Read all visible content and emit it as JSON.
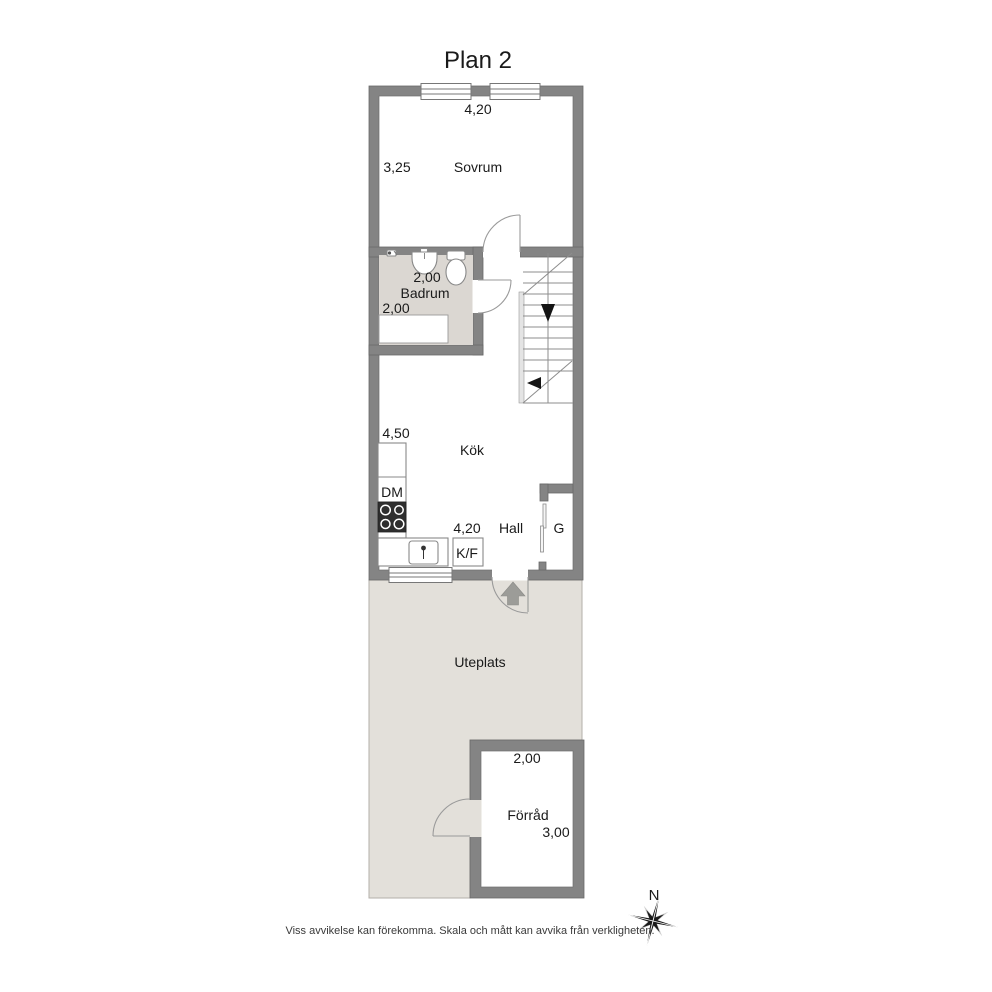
{
  "title": "Plan 2",
  "disclaimer": "Viss avvikelse kan förekomma. Skala och mått kan avvika från verkligheten.",
  "compass": {
    "north": "N"
  },
  "rooms": {
    "sovrum": {
      "label": "Sovrum",
      "dim_width": "4,20",
      "dim_depth": "3,25"
    },
    "badrum": {
      "label": "Badrum",
      "dim_width": "2,00",
      "dim_depth": "2,00"
    },
    "kok": {
      "label": "Kök",
      "dim_depth": "4,50",
      "dim_width": "4,20"
    },
    "hall": {
      "label": "Hall"
    },
    "uteplats": {
      "label": "Uteplats"
    },
    "forrad": {
      "label": "Förråd",
      "dim_width": "2,00",
      "dim_depth": "3,00"
    }
  },
  "appliances": {
    "dishwasher": "DM",
    "fridge_freezer": "K/F",
    "wardrobe": "G"
  },
  "colors": {
    "wall": "#848484",
    "badrum_floor": "#dbd7d2",
    "uteplats_floor": "#e3e0da",
    "stove": "#2e2e2e",
    "entry_arrow": "#9c9c98"
  }
}
